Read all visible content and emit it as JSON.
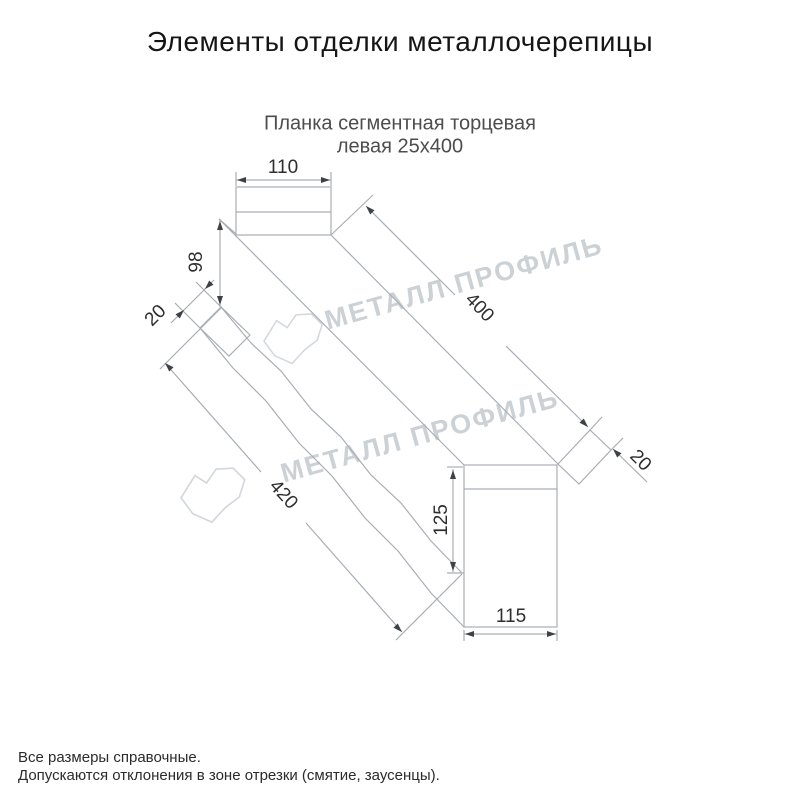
{
  "page": {
    "title": "Элементы отделки металлочерепицы",
    "subtitle1": "Планка сегментная торцевая",
    "subtitle2": "левая 25х400"
  },
  "watermark": {
    "text": "МЕТАЛЛ ПРОФИЛЬ"
  },
  "drawing": {
    "dims": {
      "top_flange_width": "110",
      "far_end_height": "98",
      "far_fold": "20",
      "top_length": "400",
      "bottom_length": "420",
      "near_end_height": "125",
      "near_end_width": "115",
      "near_fold": "20"
    }
  },
  "footer": {
    "note1": "Все размеры справочные.",
    "note2": "Допускаются отклонения в зоне отрезки (смятие, заусенцы)."
  }
}
